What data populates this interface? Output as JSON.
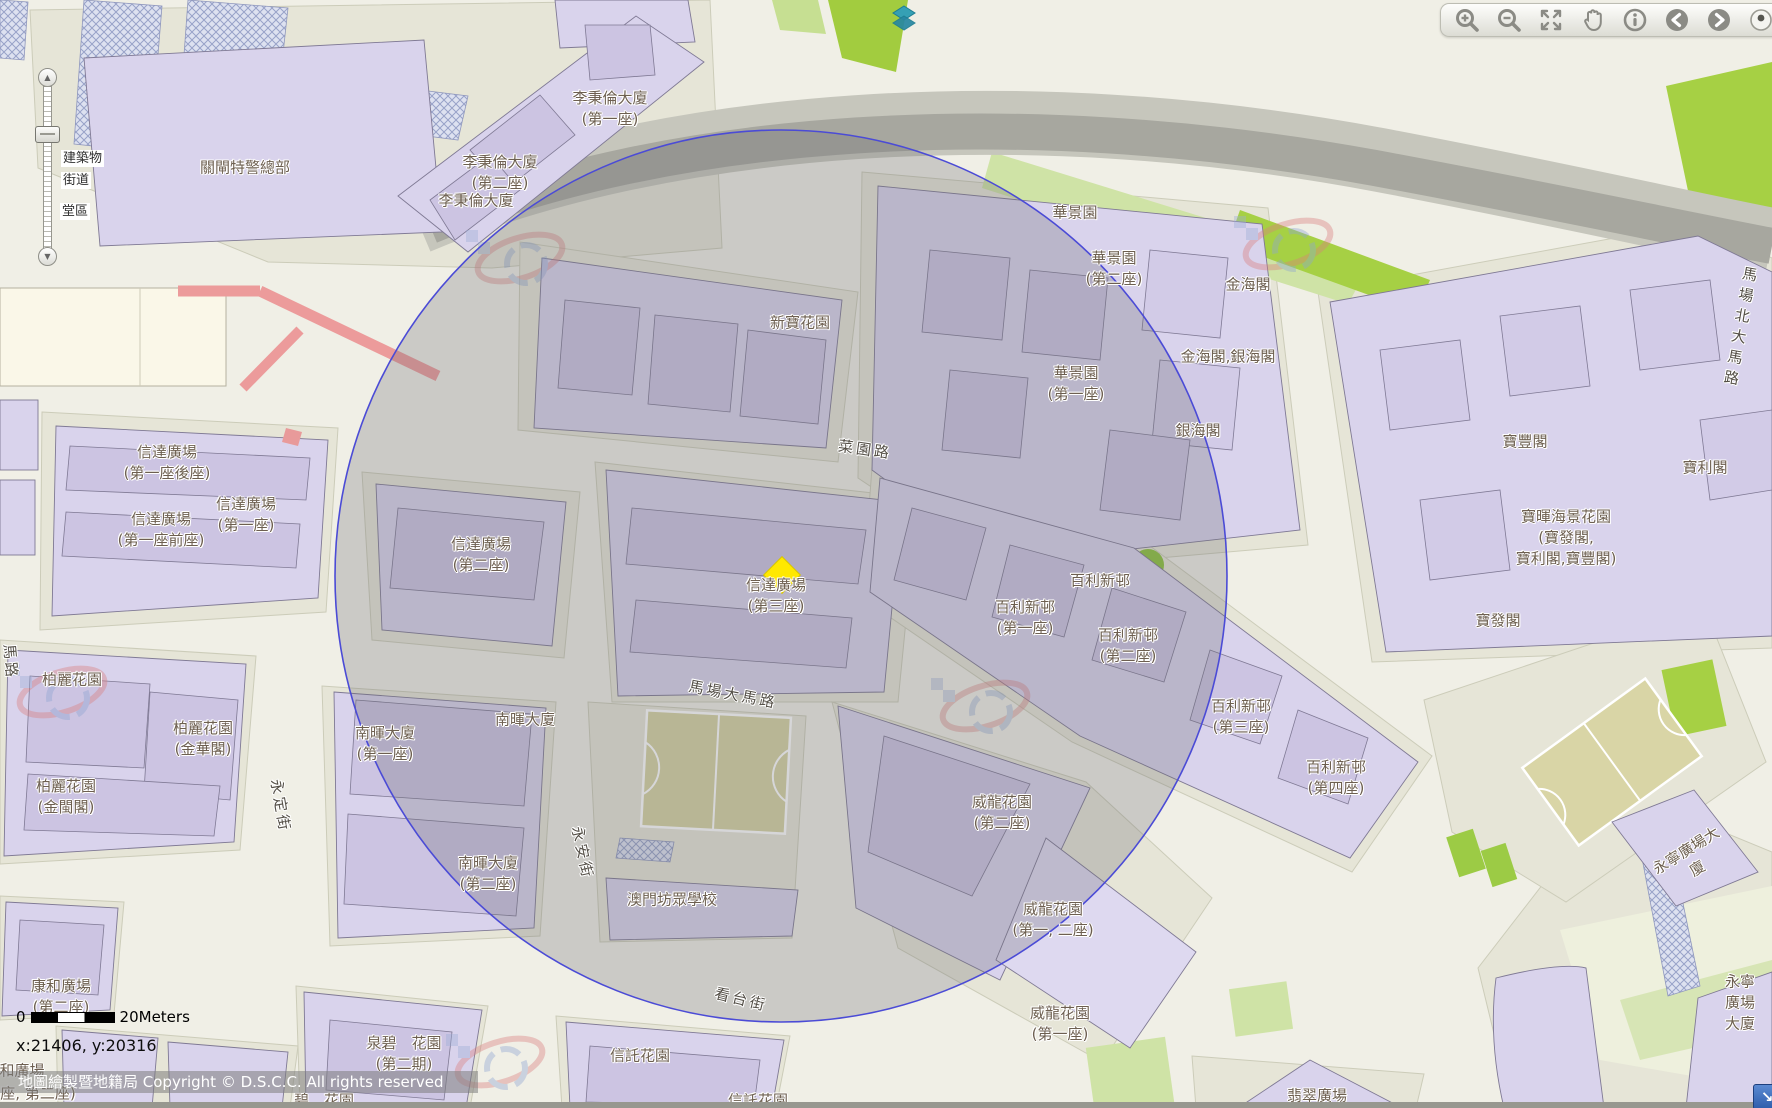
{
  "toolbar": {
    "icons": [
      "zoom-in",
      "zoom-out",
      "full-extent",
      "pan",
      "identify",
      "previous-extent",
      "next-extent",
      "overview-dot"
    ]
  },
  "layer_panel": {
    "items": [
      "建築物",
      "街道",
      "堂區"
    ]
  },
  "scale_bar": {
    "zero": "0",
    "label": "20Meters"
  },
  "status": {
    "coordinates": "x:21406, y:20316"
  },
  "copyright": "地圖繪製暨地籍局 Copyright © D.S.C.C. All rights reserved",
  "marker": {
    "shape": "diamond",
    "color": "#ffe800",
    "x": 782,
    "y": 575
  },
  "buffer_circle": {
    "cx": 781,
    "cy": 576,
    "r": 446,
    "stroke": "#4b4bd6"
  },
  "colors": {
    "building_fill": "#d9d3ec",
    "building_inner": "#ccc4e2",
    "lot": "#e6e5d7",
    "road": "#f0efe6",
    "green": "#a6d044",
    "band_gray": "#a7a79f",
    "label_text": "#6d5f50"
  },
  "map": {
    "labels": [
      {
        "text": "關閘特警總部",
        "x": 245,
        "y": 168
      },
      {
        "text": "李秉倫大廈\n(第一座)",
        "x": 610,
        "y": 109
      },
      {
        "text": "李秉倫大廈\n(第二座)",
        "x": 500,
        "y": 173
      },
      {
        "text": "李秉倫大廈",
        "x": 476,
        "y": 201
      },
      {
        "text": "新寶花園",
        "x": 800,
        "y": 323
      },
      {
        "text": "華景園",
        "x": 1075,
        "y": 213
      },
      {
        "text": "華景園\n(第二座)",
        "x": 1114,
        "y": 269
      },
      {
        "text": "金海閣",
        "x": 1248,
        "y": 285
      },
      {
        "text": "金海閣,銀海閣",
        "x": 1228,
        "y": 357
      },
      {
        "text": "華景園\n(第一座)",
        "x": 1076,
        "y": 384
      },
      {
        "text": "銀海閣",
        "x": 1198,
        "y": 431
      },
      {
        "text": "寶豐閣",
        "x": 1525,
        "y": 442
      },
      {
        "text": "寶利閣",
        "x": 1705,
        "y": 468
      },
      {
        "text": "寶暉海景花園\n(寶發閣,\n寶利閣,寶豐閣)",
        "x": 1566,
        "y": 538
      },
      {
        "text": "寶發閣",
        "x": 1498,
        "y": 621
      },
      {
        "text": "信達廣場\n(第一座後座)",
        "x": 167,
        "y": 463
      },
      {
        "text": "信達廣場\n(第一座)",
        "x": 246,
        "y": 515
      },
      {
        "text": "信達廣場\n(第一座前座)",
        "x": 161,
        "y": 530
      },
      {
        "text": "信達廣場\n(第二座)",
        "x": 481,
        "y": 555
      },
      {
        "text": "信達廣場\n(第三座)",
        "x": 776,
        "y": 596
      },
      {
        "text": "百利新邨",
        "x": 1100,
        "y": 581
      },
      {
        "text": "百利新邨\n(第一座)",
        "x": 1025,
        "y": 618
      },
      {
        "text": "百利新邨\n(第二座)",
        "x": 1128,
        "y": 646
      },
      {
        "text": "百利新邨\n(第三座)",
        "x": 1241,
        "y": 717
      },
      {
        "text": "百利新邨\n(第四座)",
        "x": 1336,
        "y": 778
      },
      {
        "text": "柏麗花園",
        "x": 72,
        "y": 680
      },
      {
        "text": "柏麗花園\n(金華閣)",
        "x": 203,
        "y": 739
      },
      {
        "text": "柏麗花園\n(金閩閣)",
        "x": 66,
        "y": 797
      },
      {
        "text": "南暉大廈",
        "x": 525,
        "y": 720
      },
      {
        "text": "南暉大廈\n(第一座)",
        "x": 385,
        "y": 744
      },
      {
        "text": "南暉大廈\n(第二座)",
        "x": 488,
        "y": 874
      },
      {
        "text": "澳門坊眾學校",
        "x": 672,
        "y": 900
      },
      {
        "text": "威龍花園\n(第二座)",
        "x": 1002,
        "y": 813
      },
      {
        "text": "威龍花園\n(第一, 二座)",
        "x": 1053,
        "y": 920
      },
      {
        "text": "威龍花園\n(第一座)",
        "x": 1060,
        "y": 1024
      },
      {
        "text": "康和廣場\n(第二座)",
        "x": 61,
        "y": 997
      },
      {
        "text": "泉碧　花園\n(第二期)",
        "x": 404,
        "y": 1054
      },
      {
        "text": "信託花園",
        "x": 640,
        "y": 1056
      },
      {
        "text": "信託花園",
        "x": 758,
        "y": 1101
      },
      {
        "text": "翡翠廣場",
        "x": 1317,
        "y": 1096
      },
      {
        "text": "永寧廣場大廈",
        "x": 1692,
        "y": 860,
        "rot": -32
      },
      {
        "text": "永寧廣場大廈",
        "x": 1740,
        "y": 1003
      },
      {
        "text": "和廣場",
        "x": 22,
        "y": 1071
      },
      {
        "text": "座, 第二座)",
        "x": 38,
        "y": 1094
      },
      {
        "text": "碧　花園",
        "x": 324,
        "y": 1101
      },
      {
        "text": "菜園路",
        "x": 865,
        "y": 450,
        "rot": 8,
        "kind": "street"
      },
      {
        "text": "馬場大馬路",
        "x": 733,
        "y": 695,
        "rot": 11,
        "kind": "street"
      },
      {
        "text": "看台街",
        "x": 741,
        "y": 1000,
        "rot": 14,
        "kind": "street"
      },
      {
        "text": "永安街",
        "x": 582,
        "y": 853,
        "rot": 78,
        "kind": "street"
      },
      {
        "text": "永定街",
        "x": 280,
        "y": 806,
        "rot": 80,
        "kind": "street"
      },
      {
        "text": "馬路",
        "x": 10,
        "y": 662,
        "rot": 85,
        "kind": "street"
      },
      {
        "text": "馬場北大馬路",
        "x": 1742,
        "y": 327,
        "rot": 10,
        "kind": "street"
      }
    ]
  }
}
